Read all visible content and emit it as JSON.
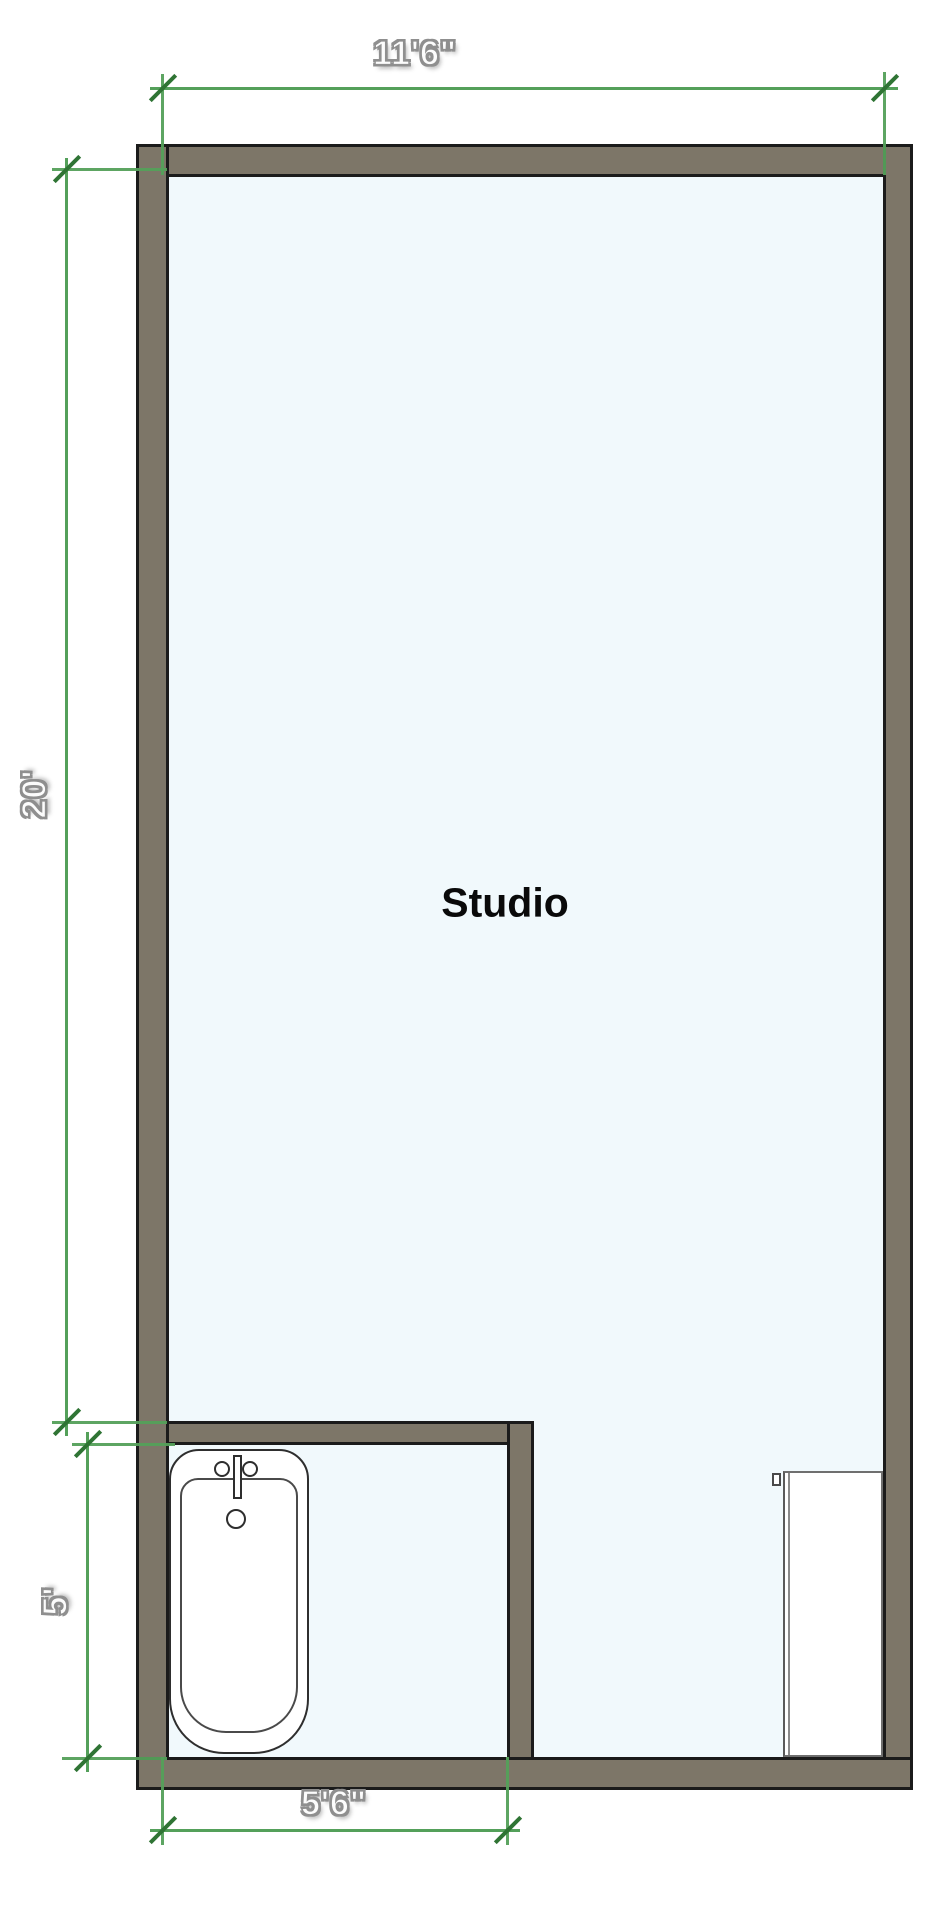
{
  "floor_plan": {
    "room_label": "Studio",
    "dimensions": {
      "top_width": "11'6\"",
      "left_height": "20'",
      "bathroom_height": "5'",
      "bathroom_width": "5'6\""
    },
    "fixtures": [
      "bathtub",
      "door-panel"
    ],
    "colors": {
      "background": "#ffffff",
      "wall_fill": "#7d7668",
      "wall_outline": "#1b1b1b",
      "floor_fill": "#f1f9fc",
      "dimension_line_green": "#54a05a",
      "dimension_tick_green": "#2f7434",
      "dimension_text_fill": "#fcfcfc",
      "dimension_text_outline": "#8f8f8f",
      "room_label_color": "#0a0a0a"
    }
  }
}
